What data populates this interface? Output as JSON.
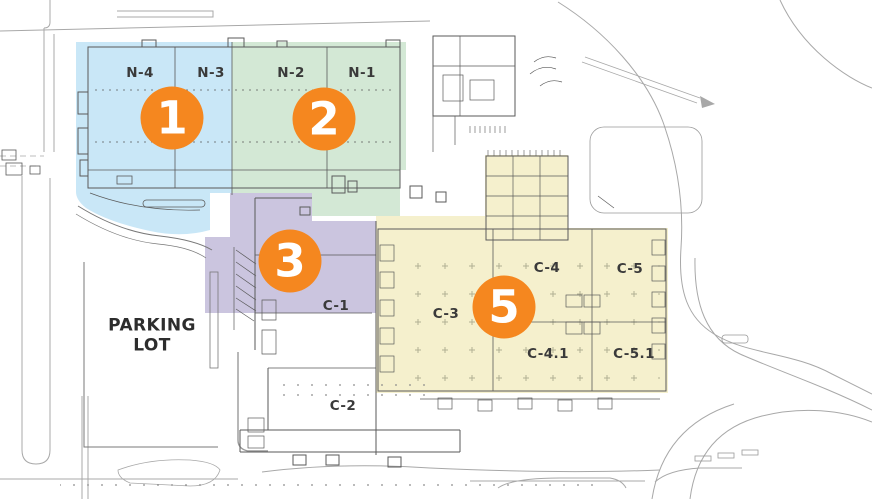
{
  "zones": {
    "zone1": {
      "badge_number": "1",
      "fill": "#c9e7f7",
      "hall_labels": {
        "n4": "N-4",
        "n3": "N-3"
      }
    },
    "zone2": {
      "badge_number": "2",
      "fill": "#d3e8d5",
      "hall_labels": {
        "n2": "N-2",
        "n1": "N-1"
      }
    },
    "zone3": {
      "badge_number": "3",
      "fill": "#cbc5df",
      "hall_labels": {
        "c1": "C-1"
      }
    },
    "zone5": {
      "badge_number": "5",
      "fill": "#f5f0cd",
      "hall_labels": {
        "c3": "C-3",
        "c4": "C-4",
        "c5": "C-5",
        "c41": "C-4.1",
        "c51": "C-5.1"
      }
    }
  },
  "other_labels": {
    "c2": "C-2",
    "parking_line1": "PARKING",
    "parking_line2": "LOT"
  },
  "badge_style": {
    "background": "#f5871f",
    "text_color": "#ffffff"
  }
}
